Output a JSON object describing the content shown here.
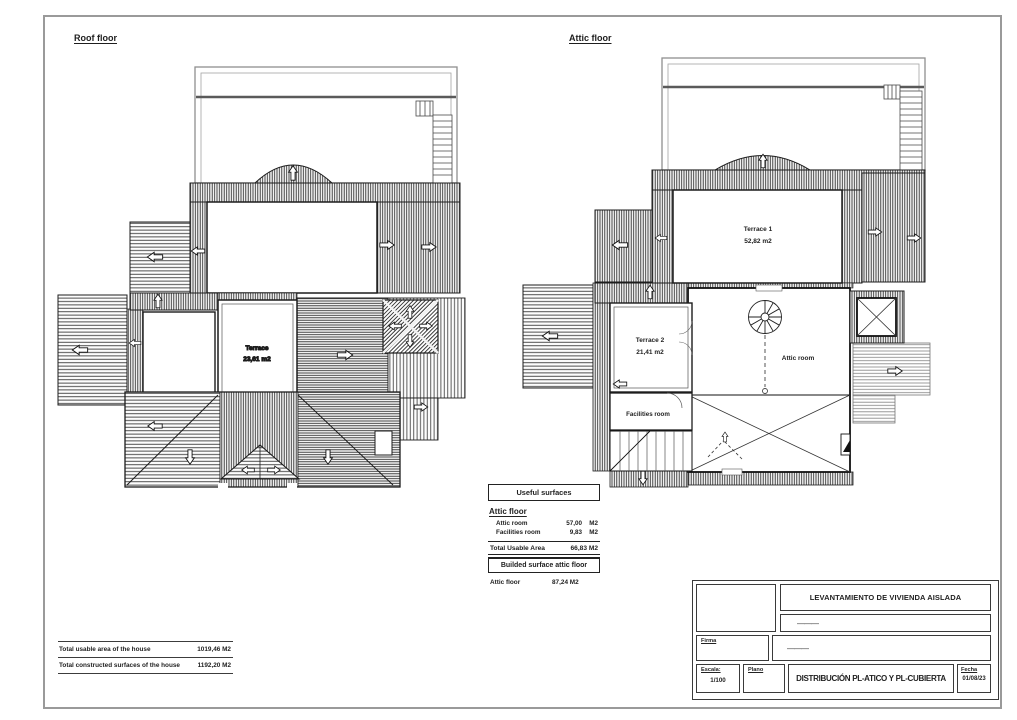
{
  "plans": {
    "roof": {
      "title": "Roof floor",
      "terrace": {
        "name": "Terrace",
        "area": "23,61 m2"
      }
    },
    "attic": {
      "title": "Attic floor",
      "terrace1": {
        "name": "Terrace 1",
        "area": "52,82 m2"
      },
      "terrace2": {
        "name": "Terrace 2",
        "area": "21,41 m2"
      },
      "attic_room": "Attic room",
      "facilities_room": "Facilities room"
    }
  },
  "useful_surfaces": {
    "title": "Useful surfaces",
    "section": "Attic floor",
    "rows": [
      {
        "label": "Attic room",
        "value": "57,00",
        "unit": "M2"
      },
      {
        "label": "Facilities room",
        "value": "9,83",
        "unit": "M2"
      }
    ],
    "total_label": "Total Usable Area",
    "total_value": "66,83 M2"
  },
  "built_surface": {
    "title": "Builded surface attic floor",
    "row": {
      "label": "Attic floor",
      "value": "87,24 M2"
    }
  },
  "house_totals": {
    "rows": [
      {
        "label": "Total usable area of the house",
        "value": "1019,46 M2"
      },
      {
        "label": "Total constructed surfaces of the house",
        "value": "1192,20 M2"
      }
    ]
  },
  "title_block": {
    "project_title": "LEVANTAMIENTO DE VIVIENDA AISLADA",
    "project_ref": "———",
    "firma_label": "Firma",
    "firma_value": "———",
    "escala_label": "Escala:",
    "escala_value": "1/100",
    "plano_label": "Plano",
    "drawing_title": "DISTRIBUCIÓN PL-ATICO Y PL-CUBIERTA",
    "fecha_label": "Fecha",
    "fecha_value": "01/08/23"
  }
}
